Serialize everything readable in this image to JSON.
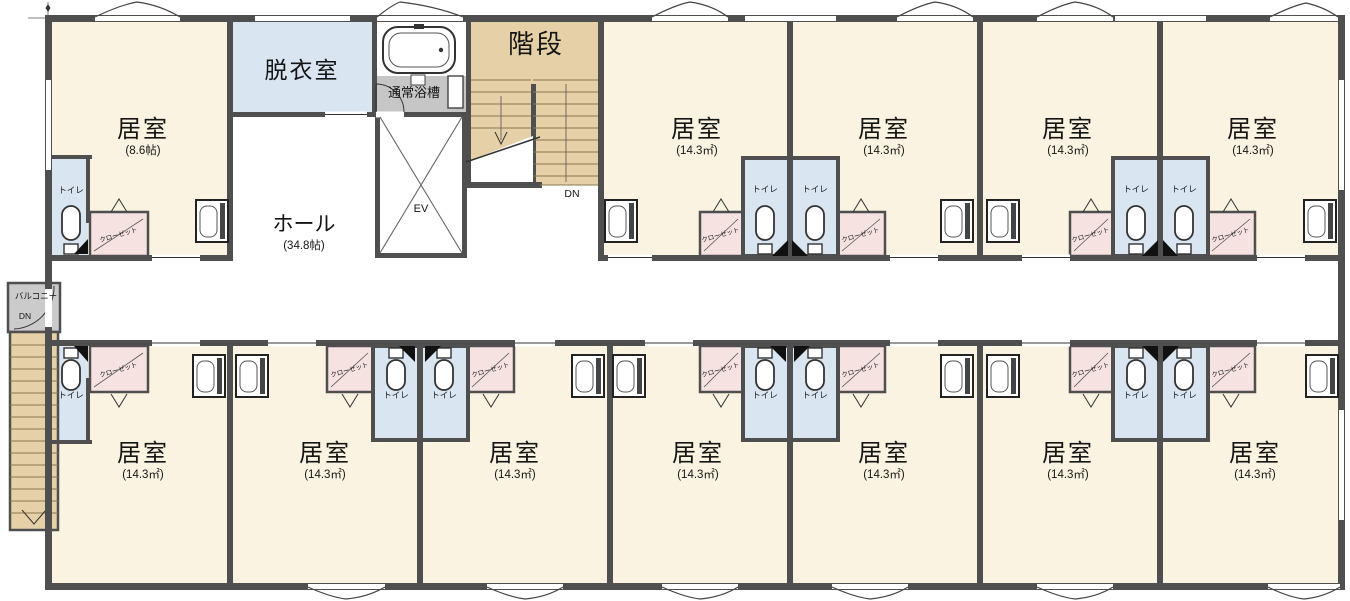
{
  "floor_plan": {
    "rooms_top": [
      {
        "name": "居室",
        "area": "(8.6帖)"
      },
      {
        "name": "居室",
        "area": "(14.3㎡)"
      },
      {
        "name": "居室",
        "area": "(14.3㎡)"
      },
      {
        "name": "居室",
        "area": "(14.3㎡)"
      },
      {
        "name": "居室",
        "area": "(14.3㎡)"
      }
    ],
    "rooms_bottom": [
      {
        "name": "居室",
        "area": "(14.3㎡)"
      },
      {
        "name": "居室",
        "area": "(14.3㎡)"
      },
      {
        "name": "居室",
        "area": "(14.3㎡)"
      },
      {
        "name": "居室",
        "area": "(14.3㎡)"
      },
      {
        "name": "居室",
        "area": "(14.3㎡)"
      },
      {
        "name": "居室",
        "area": "(14.3㎡)"
      },
      {
        "name": "居室",
        "area": "(14.3㎡)"
      }
    ],
    "hall": {
      "name": "ホール",
      "area": "(34.8帖)"
    },
    "dressing_room": "脱衣室",
    "bath": "通常浴槽",
    "stairs": "階段",
    "stairs_down": "DN",
    "elevator": "EV",
    "balcony": "バルコニー",
    "balcony_down": "DN",
    "toilet": "トイレ",
    "closet": "クローゼット",
    "colors": {
      "room_fill": "#faf3e1",
      "wet_area_fill": "#d9e6f2",
      "closet_fill": "#f5e2e1",
      "stair_fill": "#e5d0a7",
      "balcony_fill": "#cbcbcb",
      "bath_floor": "#c6c6c6",
      "wall": "#4f4f4f"
    }
  }
}
